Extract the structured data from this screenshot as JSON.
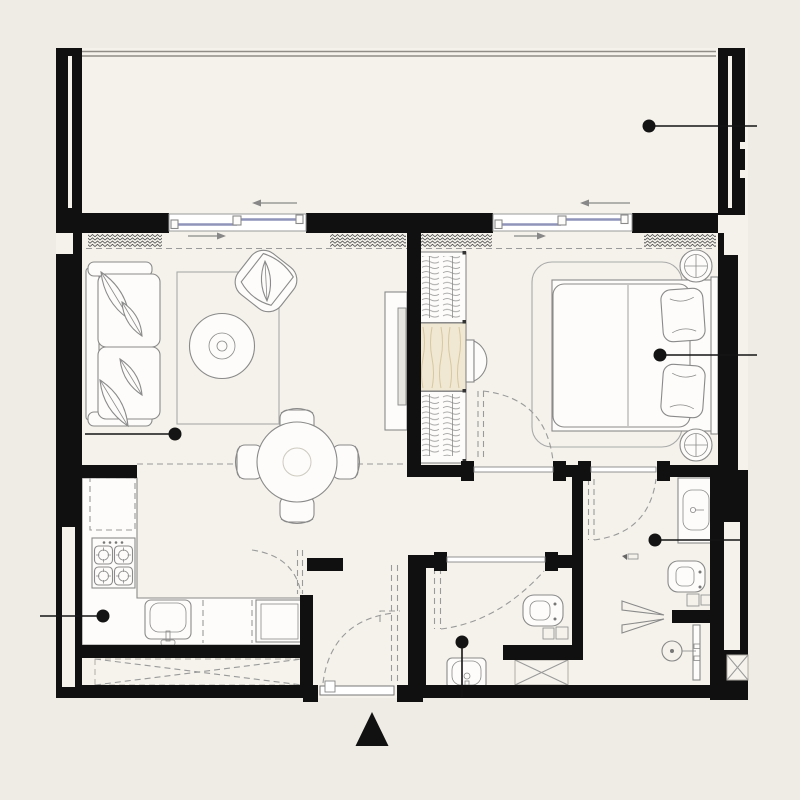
{
  "theme": {
    "bg": "#efece5",
    "floor": "#f4f2eb",
    "wall": "#101010",
    "line": "#8a8a8a",
    "dash": "#9a9a9a",
    "glass": "#8f94b8",
    "desk": "#f0e8d2",
    "grain": "#d8c7a0",
    "marker": "#141414",
    "furniture": "#fdfcfa"
  },
  "plan": {
    "type": "apartment-floor-plan",
    "rooms": [
      {
        "name": "balcony",
        "features": [
          "railing",
          "sliding-door-arrows"
        ]
      },
      {
        "name": "living-room",
        "features": [
          "sofa",
          "leaf-pillows",
          "rug",
          "round-coffee-table",
          "armchair",
          "tv-console"
        ]
      },
      {
        "name": "dining-area",
        "features": [
          "round-table",
          "four-chairs"
        ]
      },
      {
        "name": "bedroom",
        "features": [
          "double-bed",
          "pillows",
          "headboard",
          "bedside-tables",
          "wardrobe",
          "desk-with-chair",
          "rug"
        ]
      },
      {
        "name": "kitchen",
        "features": [
          "upper-cabinet-dashed",
          "stove-4-burners",
          "sink",
          "washing-machine",
          "counter"
        ]
      },
      {
        "name": "bathroom",
        "features": [
          "wall-hung-toilet",
          "washbasin",
          "shaft-x-box"
        ]
      },
      {
        "name": "ensuite-bathroom",
        "features": [
          "vanity-sink",
          "wall-hung-toilet",
          "shower",
          "glass-screen"
        ]
      },
      {
        "name": "entry-hall",
        "features": [
          "entrance-door",
          "door-swing-arcs"
        ]
      }
    ]
  },
  "markers": [
    {
      "name": "balcony",
      "x": 649,
      "y": 126,
      "to_x": 757,
      "to_y": 126
    },
    {
      "name": "living-room",
      "x": 175,
      "y": 434,
      "to_x": 85,
      "to_y": 434
    },
    {
      "name": "bedroom",
      "x": 660,
      "y": 355,
      "to_x": 757,
      "to_y": 355
    },
    {
      "name": "kitchen",
      "x": 103,
      "y": 616,
      "to_x": 40,
      "to_y": 616
    },
    {
      "name": "bathroom",
      "x": 462,
      "y": 642,
      "to_x": 462,
      "to_y": 697
    },
    {
      "name": "ensuite",
      "x": 655,
      "y": 540,
      "to_x": 740,
      "to_y": 540
    }
  ],
  "entrance_arrow": {
    "symbol": "triangle-up",
    "points": "372,712 388.5,746 355.5,746"
  },
  "sliding_door_arrows": [
    {
      "name": "balcony-left-slider",
      "x1": 297,
      "y1": 203,
      "x2": 252,
      "y2": 203,
      "dir": "left"
    },
    {
      "name": "balcony-right-slider",
      "x1": 630,
      "y1": 203,
      "x2": 580,
      "y2": 203,
      "dir": "left"
    },
    {
      "name": "living-curtain",
      "x1": 188,
      "y1": 236,
      "x2": 226,
      "y2": 236,
      "dir": "right"
    },
    {
      "name": "bedroom-curtain",
      "x1": 514,
      "y1": 236,
      "x2": 546,
      "y2": 236,
      "dir": "right"
    }
  ]
}
